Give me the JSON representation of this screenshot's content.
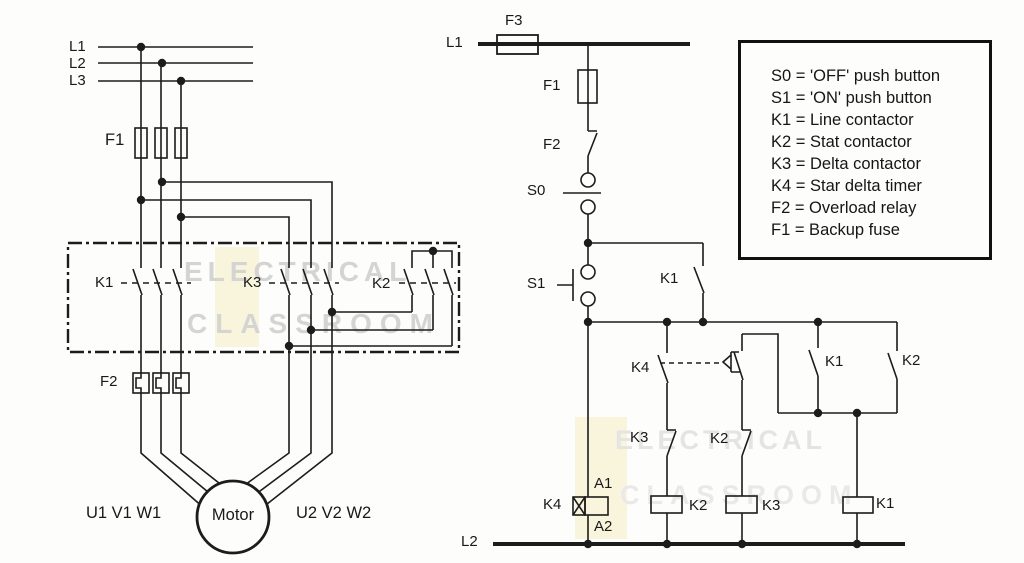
{
  "diagram": {
    "power": {
      "l1": "L1",
      "l2": "L2",
      "l3": "L3",
      "f1": "F1",
      "k1": "K1",
      "k3": "K3",
      "k2": "K2",
      "f2": "F2",
      "terminals_left": "U1 V1 W1",
      "motor": "Motor",
      "terminals_right": "U2 V2 W2"
    },
    "control": {
      "l1": "L1",
      "f3": "F3",
      "f1": "F1",
      "f2": "F2",
      "s0": "S0",
      "s1": "S1",
      "k1_holding": "K1",
      "k4_contact": "K4",
      "k1_aux": "K1",
      "k2_aux": "K2",
      "k3_interlock": "K3",
      "k2_interlock": "K2",
      "k4_coil": "K4",
      "a1": "A1",
      "a2": "A2",
      "k2_coil": "K2",
      "k3_coil": "K3",
      "k1_coil": "K1",
      "l2": "L2"
    }
  },
  "legend": {
    "items": [
      "S0 = 'OFF' push button",
      "S1 = 'ON' push button",
      "K1 = Line contactor",
      "K2 = Stat contactor",
      "K3 = Delta contactor",
      "K4 = Star delta timer",
      "F2 = Overload relay",
      "F1 = Backup fuse"
    ]
  },
  "watermark": {
    "line1": "ELECTRICAL",
    "line2": "CLASSROOM"
  },
  "colors": {
    "line": "#1c1c1c",
    "background": "#fdfdfc",
    "watermark": "#d4d4d2",
    "watermark_faint": "#e4e4e2",
    "highlight": "#f7f0c8"
  }
}
